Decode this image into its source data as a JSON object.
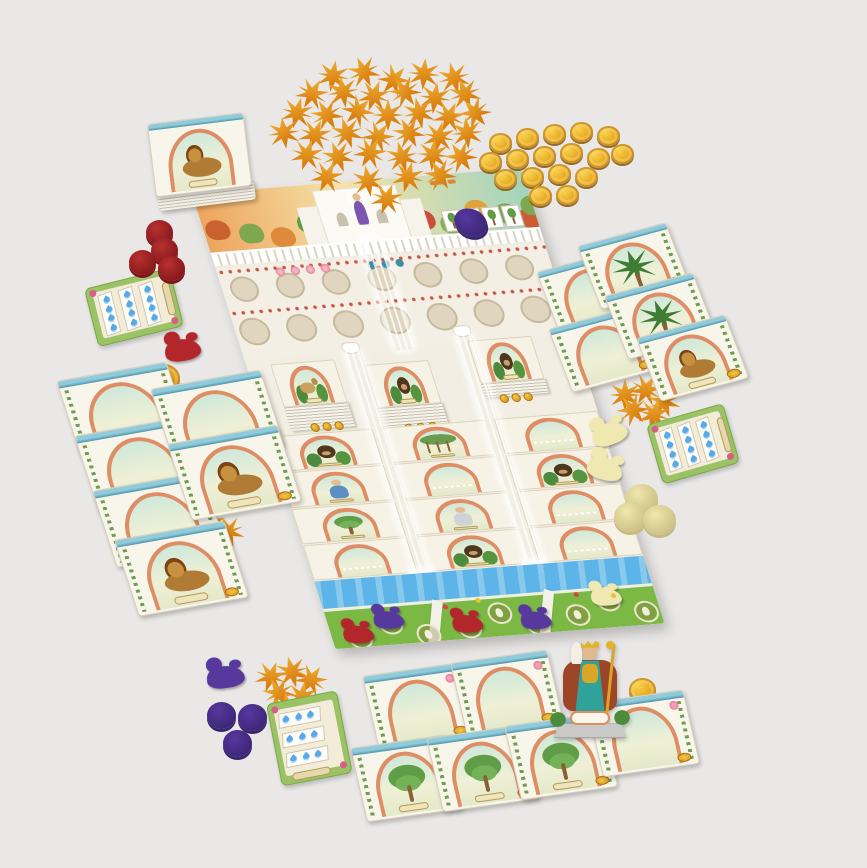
{
  "scene": {
    "width": 867,
    "height": 868,
    "background": "#e9e8e7",
    "description": "Product flat-lay of a Hanging-Gardens-of-Babylon style board game: central illustrated board with arch tiles and waterfalls, card tableaus, star and coin tokens, player discs, gardener meeples, score pads and a king standee"
  },
  "palette": {
    "board_cream": "#f2eee3",
    "arch_orange": "#df8d64",
    "teal_band": "#8fcbdb",
    "grass": "#7cb844",
    "river": "#5cb4e8",
    "waterfall": "#aadcf7",
    "gold": "#e3a020",
    "star_orange": "#e18d14",
    "player_red": "#b3262b",
    "player_purple": "#57399e",
    "player_cream": "#efe8b0",
    "pad_green": "#9cc266",
    "drop_blue": "#58aae6"
  },
  "disc_colors": {
    "red": {
      "face": "#b8312f",
      "rim": "#7e1519"
    },
    "purple": {
      "face": "#55389f",
      "rim": "#39246e"
    },
    "cream": {
      "face": "#efe7ac",
      "rim": "#c5ba80"
    }
  },
  "board": {
    "x": 192,
    "y": 194,
    "w": 330,
    "h": 465,
    "rot": -4.5,
    "skew": 13,
    "sky": [
      "#eda55e",
      "#f6e2a9",
      "#a2d4bc"
    ],
    "bushes": [
      "#c9622f",
      "#7da84f",
      "#dd8a3a",
      "#5f9c45",
      "#c94f39",
      "#88b054",
      "#e0a23c",
      "#6fa04a",
      "#cc5c31",
      "#7da84f"
    ],
    "stacks": [
      {
        "x": 24,
        "y": 176,
        "layers": 26,
        "motif": "goat"
      },
      {
        "x": 116,
        "y": 184,
        "layers": 30,
        "motif": "bear"
      },
      {
        "x": 224,
        "y": 168,
        "layers": 16,
        "motif": "bear"
      }
    ],
    "coin_triplets": [
      {
        "x": 44,
        "y": 238
      },
      {
        "x": 136,
        "y": 246
      },
      {
        "x": 238,
        "y": 224
      }
    ],
    "grid": [
      [
        "bear",
        "banyan",
        "empty"
      ],
      [
        "woman",
        "empty",
        "bear"
      ],
      [
        "tree",
        "man",
        "empty"
      ],
      [
        "empty",
        "bear",
        "empty"
      ]
    ],
    "purple_disc": {
      "x": 248,
      "y": 36,
      "d": 32
    },
    "plots": [
      {
        "circles": [
          [
            16,
            18
          ],
          [
            50,
            6
          ],
          [
            84,
            20
          ]
        ],
        "meeples": [
          {
            "ci": 0,
            "color": "red"
          },
          {
            "ci": 1,
            "color": "purple"
          }
        ]
      },
      {
        "circles": [
          [
            126,
            16
          ],
          [
            160,
            4
          ],
          [
            194,
            18
          ]
        ],
        "meeples": [
          {
            "ci": 0,
            "color": "red"
          },
          {
            "ci": 2,
            "color": "purple"
          }
        ]
      },
      {
        "circles": [
          [
            236,
            12
          ],
          [
            270,
            0
          ],
          [
            304,
            14
          ]
        ],
        "meeples": [
          {
            "ci": 1,
            "color": "cream"
          }
        ]
      }
    ],
    "grass_flowers": [
      [
        118,
        2,
        "#d84444"
      ],
      [
        152,
        -2,
        "#e6c33a"
      ],
      [
        250,
        0,
        "#d84444"
      ],
      [
        286,
        4,
        "#e6c33a"
      ]
    ]
  },
  "deck": {
    "x": 147,
    "y": 124,
    "w": 97,
    "h": 74,
    "rot": -7,
    "thickness": 16,
    "motif": "lion"
  },
  "star_scatter": {
    "size": 32,
    "items": [
      [
        317,
        60,
        10
      ],
      [
        348,
        56,
        -25
      ],
      [
        378,
        64,
        40
      ],
      [
        408,
        58,
        5
      ],
      [
        438,
        62,
        -15
      ],
      [
        296,
        78,
        30
      ],
      [
        327,
        76,
        -10
      ],
      [
        358,
        80,
        20
      ],
      [
        389,
        76,
        -35
      ],
      [
        419,
        82,
        8
      ],
      [
        449,
        78,
        -20
      ],
      [
        281,
        97,
        15
      ],
      [
        311,
        99,
        -30
      ],
      [
        342,
        95,
        45
      ],
      [
        372,
        99,
        0
      ],
      [
        403,
        97,
        -12
      ],
      [
        433,
        101,
        25
      ],
      [
        459,
        97,
        -40
      ],
      [
        268,
        117,
        -8
      ],
      [
        299,
        119,
        22
      ],
      [
        331,
        117,
        -18
      ],
      [
        362,
        121,
        35
      ],
      [
        393,
        117,
        -28
      ],
      [
        423,
        121,
        12
      ],
      [
        451,
        117,
        -5
      ],
      [
        291,
        139,
        18
      ],
      [
        322,
        141,
        -22
      ],
      [
        354,
        137,
        30
      ],
      [
        386,
        141,
        -15
      ],
      [
        417,
        139,
        5
      ],
      [
        445,
        141,
        -35
      ],
      [
        311,
        161,
        25
      ],
      [
        352,
        165,
        -10
      ],
      [
        392,
        161,
        15
      ],
      [
        424,
        159,
        -30
      ],
      [
        371,
        183,
        20
      ]
    ]
  },
  "star_piles": {
    "left": [
      [
        193,
        508,
        15
      ],
      [
        212,
        516,
        -20
      ],
      [
        201,
        527,
        40
      ]
    ],
    "right": [
      [
        609,
        379,
        0
      ],
      [
        630,
        374,
        30
      ],
      [
        648,
        386,
        -20
      ],
      [
        617,
        394,
        -40
      ],
      [
        638,
        399,
        15
      ]
    ],
    "bottom": [
      [
        255,
        661,
        20
      ],
      [
        276,
        656,
        -15
      ],
      [
        295,
        664,
        35
      ],
      [
        263,
        677,
        -30
      ],
      [
        286,
        681,
        10
      ],
      [
        271,
        692,
        -5
      ]
    ]
  },
  "coin_scatter": {
    "d": 23,
    "items": [
      [
        489,
        133
      ],
      [
        516,
        128
      ],
      [
        543,
        124
      ],
      [
        570,
        122
      ],
      [
        597,
        126
      ],
      [
        479,
        152
      ],
      [
        506,
        149
      ],
      [
        533,
        146
      ],
      [
        560,
        143
      ],
      [
        587,
        148
      ],
      [
        611,
        144
      ],
      [
        494,
        169
      ],
      [
        521,
        167
      ],
      [
        548,
        164
      ],
      [
        575,
        167
      ],
      [
        529,
        186
      ],
      [
        556,
        185
      ]
    ]
  },
  "single_coins": [
    {
      "x": 143,
      "y": 370,
      "d": 33
    },
    {
      "x": 147,
      "y": 364,
      "d": 33
    },
    {
      "x": 629,
      "y": 678,
      "d": 27
    }
  ],
  "card_groups": [
    {
      "name": "tableau-left-col-a",
      "w": 112,
      "h": 80,
      "rot": -10,
      "skew": 8,
      "cards": [
        {
          "x": 56,
          "y": 381,
          "motif": "empty"
        },
        {
          "x": 74,
          "y": 436,
          "motif": "empty"
        },
        {
          "x": 92,
          "y": 491,
          "motif": "empty"
        },
        {
          "x": 114,
          "y": 540,
          "motif": "lion"
        }
      ]
    },
    {
      "name": "tableau-left-col-b",
      "w": 112,
      "h": 80,
      "rot": -10,
      "skew": 8,
      "cards": [
        {
          "x": 150,
          "y": 389,
          "motif": "empty"
        },
        {
          "x": 167,
          "y": 444,
          "motif": "lion"
        }
      ]
    },
    {
      "name": "tableau-right-col-a",
      "w": 92,
      "h": 68,
      "rot": -15,
      "skew": 6,
      "cards": [
        {
          "x": 536,
          "y": 272,
          "motif": "empty"
        },
        {
          "x": 548,
          "y": 329,
          "motif": "empty"
        }
      ]
    },
    {
      "name": "tableau-right-col-b",
      "w": 92,
      "h": 68,
      "rot": -15,
      "skew": 6,
      "cards": [
        {
          "x": 577,
          "y": 246,
          "motif": "palm"
        },
        {
          "x": 604,
          "y": 296,
          "motif": "palm"
        },
        {
          "x": 636,
          "y": 338,
          "motif": "lion"
        }
      ]
    },
    {
      "name": "market-row-upper",
      "w": 98,
      "h": 76,
      "rot": -8,
      "skew": 5,
      "cards": [
        {
          "x": 362,
          "y": 676,
          "motif": "empty",
          "flower": true
        },
        {
          "x": 450,
          "y": 663,
          "motif": "empty",
          "flower": true
        }
      ]
    },
    {
      "name": "market-row-lower",
      "w": 98,
      "h": 76,
      "rot": -8,
      "skew": 5,
      "cards": [
        {
          "x": 350,
          "y": 748,
          "motif": "tree"
        },
        {
          "x": 426,
          "y": 738,
          "motif": "tree"
        },
        {
          "x": 504,
          "y": 726,
          "motif": "tree"
        },
        {
          "x": 586,
          "y": 703,
          "motif": "empty",
          "flower": true
        }
      ]
    }
  ],
  "scorepads": [
    {
      "x": 84,
      "y": 289,
      "w": 88,
      "h": 60,
      "rot": -14,
      "orient": "v",
      "strips": 3,
      "drops": 4
    },
    {
      "x": 646,
      "y": 425,
      "w": 80,
      "h": 62,
      "rot": -16,
      "orient": "v",
      "strips": 3,
      "drops": 4
    },
    {
      "x": 266,
      "y": 704,
      "w": 72,
      "h": 84,
      "rot": -11,
      "orient": "h",
      "strips": 3,
      "drops": 3
    }
  ],
  "discs": {
    "red": [
      {
        "x": 146,
        "y": 220,
        "d": 27
      },
      {
        "x": 151,
        "y": 238,
        "d": 27
      },
      {
        "x": 129,
        "y": 250,
        "d": 27
      },
      {
        "x": 158,
        "y": 256,
        "d": 27
      }
    ],
    "purple": [
      {
        "x": 207,
        "y": 702,
        "d": 29
      },
      {
        "x": 238,
        "y": 704,
        "d": 29
      },
      {
        "x": 223,
        "y": 730,
        "d": 29
      }
    ],
    "cream": [
      {
        "x": 625,
        "y": 484,
        "d": 33
      },
      {
        "x": 614,
        "y": 502,
        "d": 33
      },
      {
        "x": 643,
        "y": 505,
        "d": 33
      }
    ]
  },
  "loose_meeples": [
    {
      "x": 164,
      "y": 330,
      "color": "red",
      "rot": -10,
      "s": 36
    },
    {
      "x": 206,
      "y": 656,
      "color": "purple",
      "rot": -8,
      "s": 38
    },
    {
      "x": 590,
      "y": 414,
      "color": "cream",
      "rot": -20,
      "s": 36
    },
    {
      "x": 588,
      "y": 449,
      "color": "cream",
      "rot": 14,
      "s": 36
    }
  ],
  "king_standee": {
    "x": 551,
    "y": 640,
    "w": 78,
    "h": 98
  }
}
